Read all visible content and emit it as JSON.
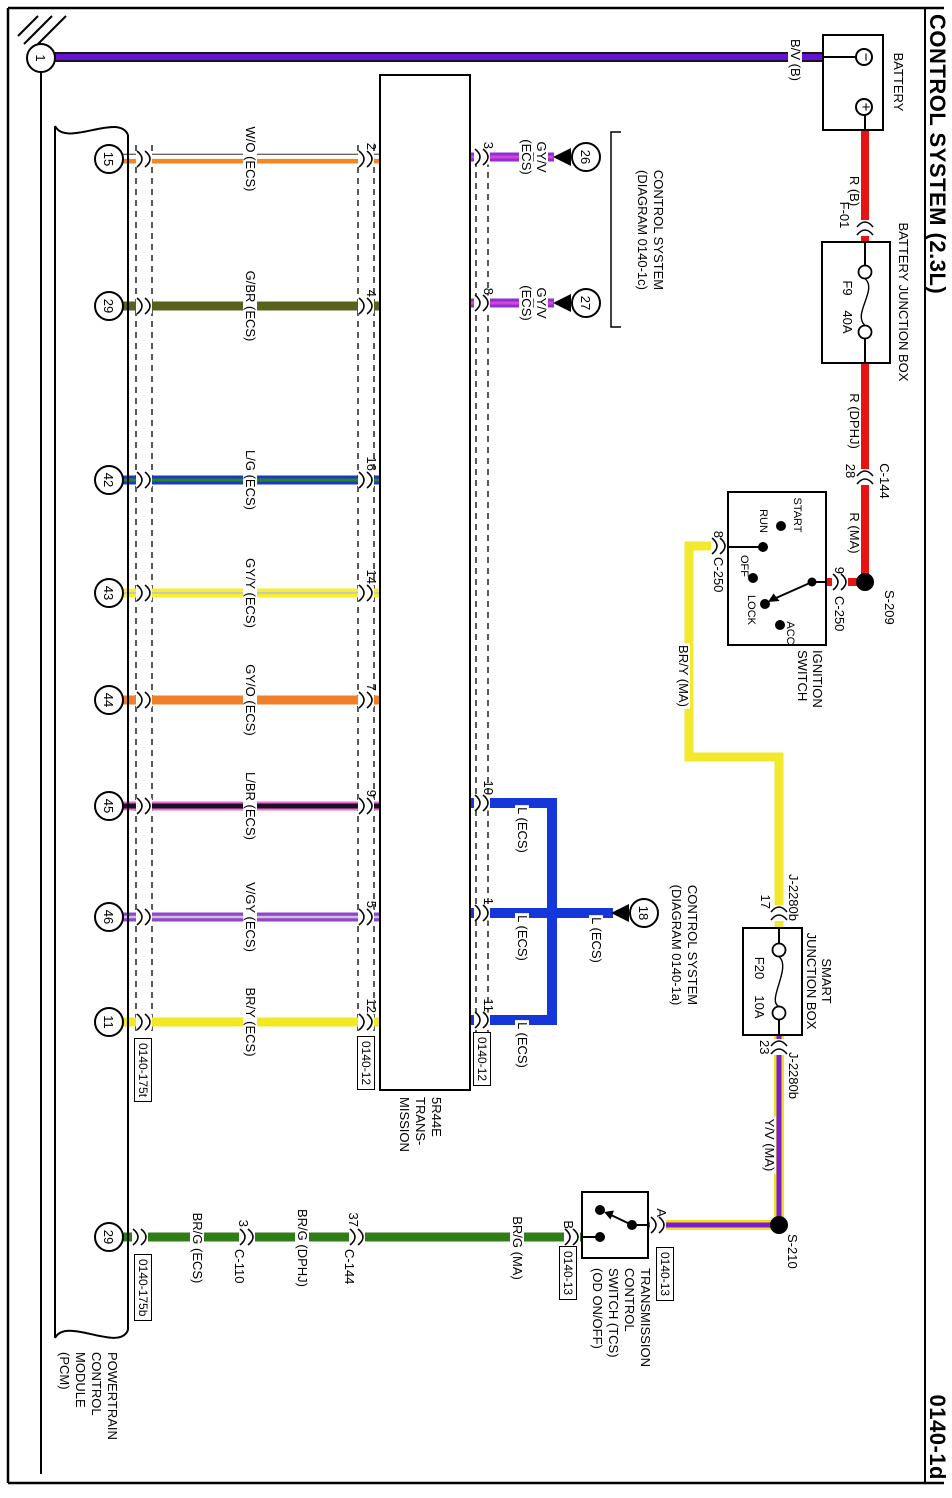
{
  "header": {
    "title": "CONTROL SYSTEM (2.3L)",
    "page_code": "0140-1d"
  },
  "ground": {
    "number": "1"
  },
  "battery": {
    "label": "BATTERY",
    "negative": "−",
    "positive": "+",
    "wire_out": "B/V (B)"
  },
  "power_feed": {
    "wire_r_b": "R (B)",
    "connector_f01": "F-01",
    "bjb": {
      "label": "BATTERY JUNCTION BOX",
      "fuse": "F9",
      "rating": "40A"
    },
    "wire_r_dphj": "R (DPHJ)",
    "c144": {
      "pin": "28",
      "name": "C-144"
    },
    "wire_r_ma": "R (MA)",
    "splice": "S-209"
  },
  "ignition_switch": {
    "entry": {
      "pin": "9",
      "name": "C-250"
    },
    "label_line1": "IGNITION",
    "label_line2": "SWITCH",
    "positions": [
      "START",
      "RUN",
      "OFF",
      "LOCK",
      "ACC"
    ],
    "exit": {
      "pin": "8",
      "name": "C-250"
    },
    "wire_out": "BR/Y (MA)"
  },
  "smart_junction_box": {
    "entry": {
      "pin": "17",
      "name": "J-2280b"
    },
    "label_line1": "SMART",
    "label_line2": "JUNCTION BOX",
    "fuse": "F20",
    "rating": "10A",
    "exit": {
      "pin": "23",
      "name": "J-2280b"
    },
    "wire_out": "Y/V (MA)",
    "splice": "S-210"
  },
  "tcs": {
    "pin_a": "A",
    "ref_a": "0140-13",
    "label_lines": [
      "TRANSMISSION",
      "CONTROL",
      "SWITCH (TCS)",
      "(OD ON/OFF)"
    ],
    "pin_b": "B",
    "ref_b": "0140-13",
    "wire_ma": "BR/G (MA)",
    "c144": {
      "pin": "37",
      "name": "C-144"
    },
    "wire_dphj": "BR/G (DPHJ)",
    "c110": {
      "pin": "3",
      "name": "C-110"
    },
    "wire_ecs": "BR/G (ECS)",
    "pcm_pin": "29"
  },
  "pcm": {
    "label_lines": [
      "POWERTRAIN",
      "CONTROL",
      "MODULE",
      "(PCM)"
    ],
    "ref_top": "0140-175t",
    "ref_bottom": "0140-175b"
  },
  "transmission": {
    "label_lines": [
      "5R44E",
      "TRANS-",
      "MISSION"
    ],
    "ref_top": "0140-12",
    "ref_bottom": "0140-12"
  },
  "ecs_wires": [
    {
      "pcm_pin": "15",
      "label": "W/O (ECS)",
      "trans_pin": "2"
    },
    {
      "pcm_pin": "29",
      "label": "G/BR (ECS)",
      "trans_pin": "4"
    },
    {
      "pcm_pin": "42",
      "label": "L/G (ECS)",
      "trans_pin": "16"
    },
    {
      "pcm_pin": "43",
      "label": "GY/Y (ECS)",
      "trans_pin": "14"
    },
    {
      "pcm_pin": "44",
      "label": "GY/O (ECS)",
      "trans_pin": "7"
    },
    {
      "pcm_pin": "45",
      "label": "L/BR (ECS)",
      "trans_pin": "9"
    },
    {
      "pcm_pin": "46",
      "label": "V/GY (ECS)",
      "trans_pin": "5"
    },
    {
      "pcm_pin": "11",
      "label": "BR/Y (ECS)",
      "trans_pin": "12"
    }
  ],
  "gyv_wires": [
    {
      "trans_pin": "3",
      "label_line1": "GY/V",
      "label_line2": "(ECS)",
      "ref": "26"
    },
    {
      "trans_pin": "8",
      "label_line1": "GY/V",
      "label_line2": "(ECS)",
      "ref": "27"
    }
  ],
  "ref_1c": {
    "line1": "CONTROL SYSTEM",
    "line2": "(DIAGRAM 0140-1c)"
  },
  "l_network": {
    "pins": [
      "10",
      "1",
      "11"
    ],
    "labels": [
      "L (ECS)",
      "L (ECS)",
      "L (ECS)",
      "L (ECS)"
    ],
    "ref": "18"
  },
  "ref_1a": {
    "line1": "CONTROL SYSTEM",
    "line2": "(DIAGRAM 0140-1a)"
  },
  "colors": {
    "red": "#e81313",
    "violet": "#6414d2",
    "yellow": "#f2e92e",
    "green": "#2f7d17",
    "blue": "#1536d8",
    "orange": "#ef7f28",
    "olive": "#59621c",
    "pink": "#ef6ad8"
  }
}
